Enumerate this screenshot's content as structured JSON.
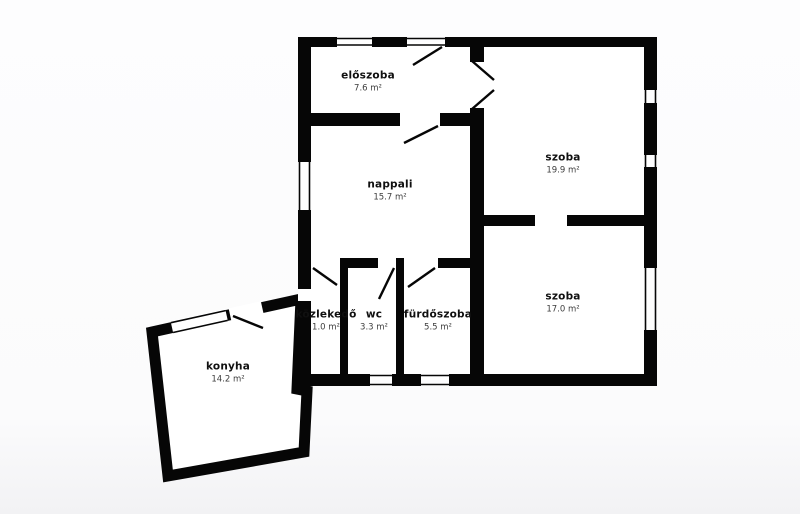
{
  "floor_plan": {
    "rooms": [
      {
        "name": "előszoba",
        "area": "7.6 m²"
      },
      {
        "name": "nappali",
        "area": "15.7 m²"
      },
      {
        "name": "szoba",
        "area": "19.9 m²"
      },
      {
        "name": "szoba",
        "area": "17.0 m²"
      },
      {
        "name": "közlekedő",
        "area": "1.0 m²"
      },
      {
        "name": "wc",
        "area": "3.3 m²"
      },
      {
        "name": "fürdőszoba",
        "area": "5.5 m²"
      },
      {
        "name": "konyha",
        "area": "14.2 m²"
      }
    ],
    "colors": {
      "wall": "#060606",
      "paper": "#ffffff",
      "room_name_text": "#101010",
      "area_text": "#3d3d3d"
    }
  }
}
